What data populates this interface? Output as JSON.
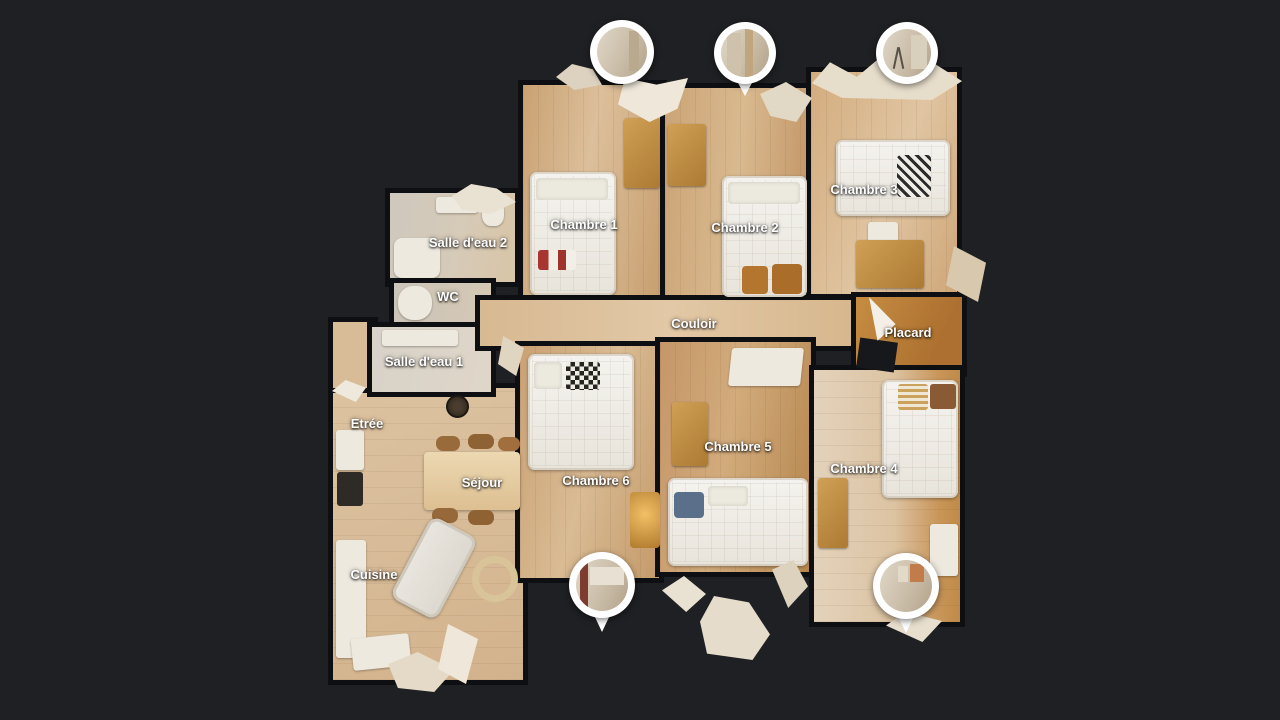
{
  "view": {
    "mode_label": "floor-plan-view",
    "background_color": "#1f2023",
    "wall_color": "#0e0f12",
    "marker_ring_color": "#ffffff",
    "label_color": "#ffffff",
    "floor_wood_color": "#d2ab80",
    "floor_bath_color": "#d4cec3"
  },
  "rooms": [
    {
      "id": "salle-deau-2",
      "label": "Salle d'eau 2"
    },
    {
      "id": "wc",
      "label": "WC"
    },
    {
      "id": "salle-deau-1",
      "label": "Salle d'eau 1"
    },
    {
      "id": "etree",
      "label": "Etrée"
    },
    {
      "id": "sejour",
      "label": "Séjour"
    },
    {
      "id": "cuisine",
      "label": "Cuisine"
    },
    {
      "id": "chambre-1",
      "label": "Chambre 1"
    },
    {
      "id": "chambre-2",
      "label": "Chambre 2"
    },
    {
      "id": "chambre-3",
      "label": "Chambre 3"
    },
    {
      "id": "couloir",
      "label": "Couloir"
    },
    {
      "id": "placard",
      "label": "Placard"
    },
    {
      "id": "chambre-6",
      "label": "Chambre 6"
    },
    {
      "id": "chambre-5",
      "label": "Chambre 5"
    },
    {
      "id": "chambre-4",
      "label": "Chambre 4"
    }
  ],
  "markers": [
    {
      "id": "pano-top-left",
      "icon": "pano-circle-icon",
      "shape": "circle"
    },
    {
      "id": "pano-top-middle",
      "icon": "pano-pin-icon",
      "shape": "pin"
    },
    {
      "id": "pano-top-right",
      "icon": "pano-circle-icon",
      "shape": "circle"
    },
    {
      "id": "pano-bottom-left",
      "icon": "pano-pin-icon",
      "shape": "pin"
    },
    {
      "id": "pano-bottom-right",
      "icon": "pano-pin-icon",
      "shape": "pin"
    }
  ]
}
